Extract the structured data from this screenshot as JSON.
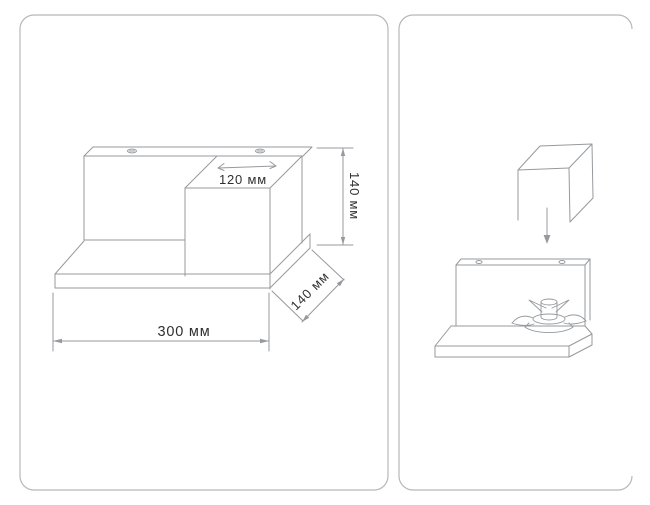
{
  "page": {
    "type": "product-assembly-illustration",
    "background": "#ffffff"
  },
  "colors": {
    "panel_border": "#b5b7b9",
    "line": "#96999d",
    "text": "#303030",
    "background": "#ffffff"
  },
  "panels": {
    "left": {
      "name": "dimensions view"
    },
    "right": {
      "name": "assembly view"
    }
  },
  "dimensions": {
    "box_width_label": "120 мм",
    "height_label": "140 мм",
    "depth_label": "140 мм",
    "width_label": "300 мм"
  },
  "icons": {
    "screw_hole": "keyhole-hanger-marker",
    "mount_hole": "round-hole-marker",
    "down_arrow": "solid-down-arrow",
    "mount_bracket": "butterfly-cam-lock"
  }
}
